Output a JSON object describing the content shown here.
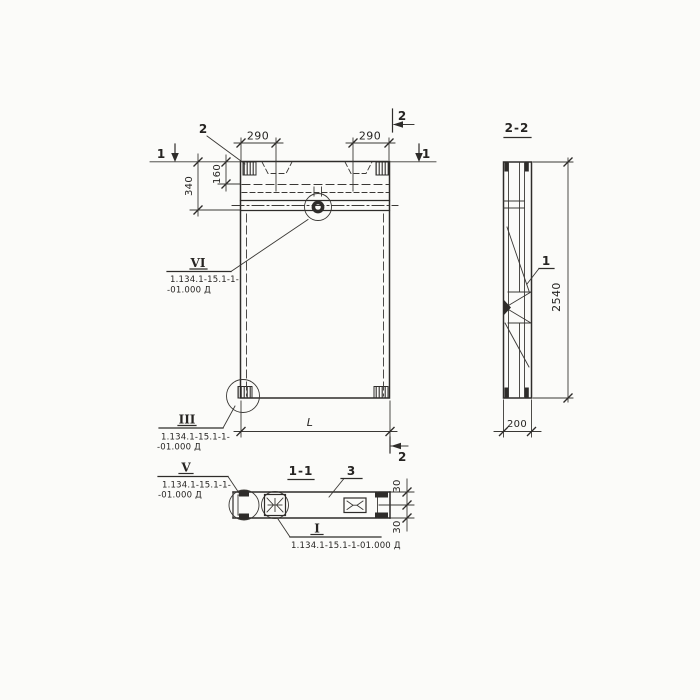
{
  "colors": {
    "line": "#2e2c2a",
    "paper": "#fbfbf9"
  },
  "front_view": {
    "dim_290_left": "290",
    "dim_290_right": "290",
    "dim_340": "340",
    "dim_160": "160",
    "dim_length": "L",
    "section1_marker_left": "1",
    "section1_marker_right": "1",
    "section2_marker_top": "2",
    "section2_marker_bottom": "2",
    "item_anchor_label": "2"
  },
  "side_view": {
    "title": "2-2",
    "item_label": "1",
    "dim_height": "2540",
    "dim_thickness": "200"
  },
  "plan_section": {
    "title": "1-1",
    "item_label": "3",
    "dim_30_top": "30",
    "dim_30_bottom": "30"
  },
  "callouts": {
    "vi": {
      "label": "VI",
      "ref_line1": "1.134.1-15.1-1-",
      "ref_line2": "-01.000 Д"
    },
    "iii": {
      "label": "III",
      "ref_line1": "1.134.1-15.1-1-",
      "ref_line2": "-01.000 Д"
    },
    "v": {
      "label": "V",
      "ref_line1": "1.134.1-15.1-1-",
      "ref_line2": "-01.000 Д"
    },
    "i": {
      "label": "I",
      "ref": "1.134.1-15.1-1-01.000 Д"
    }
  }
}
